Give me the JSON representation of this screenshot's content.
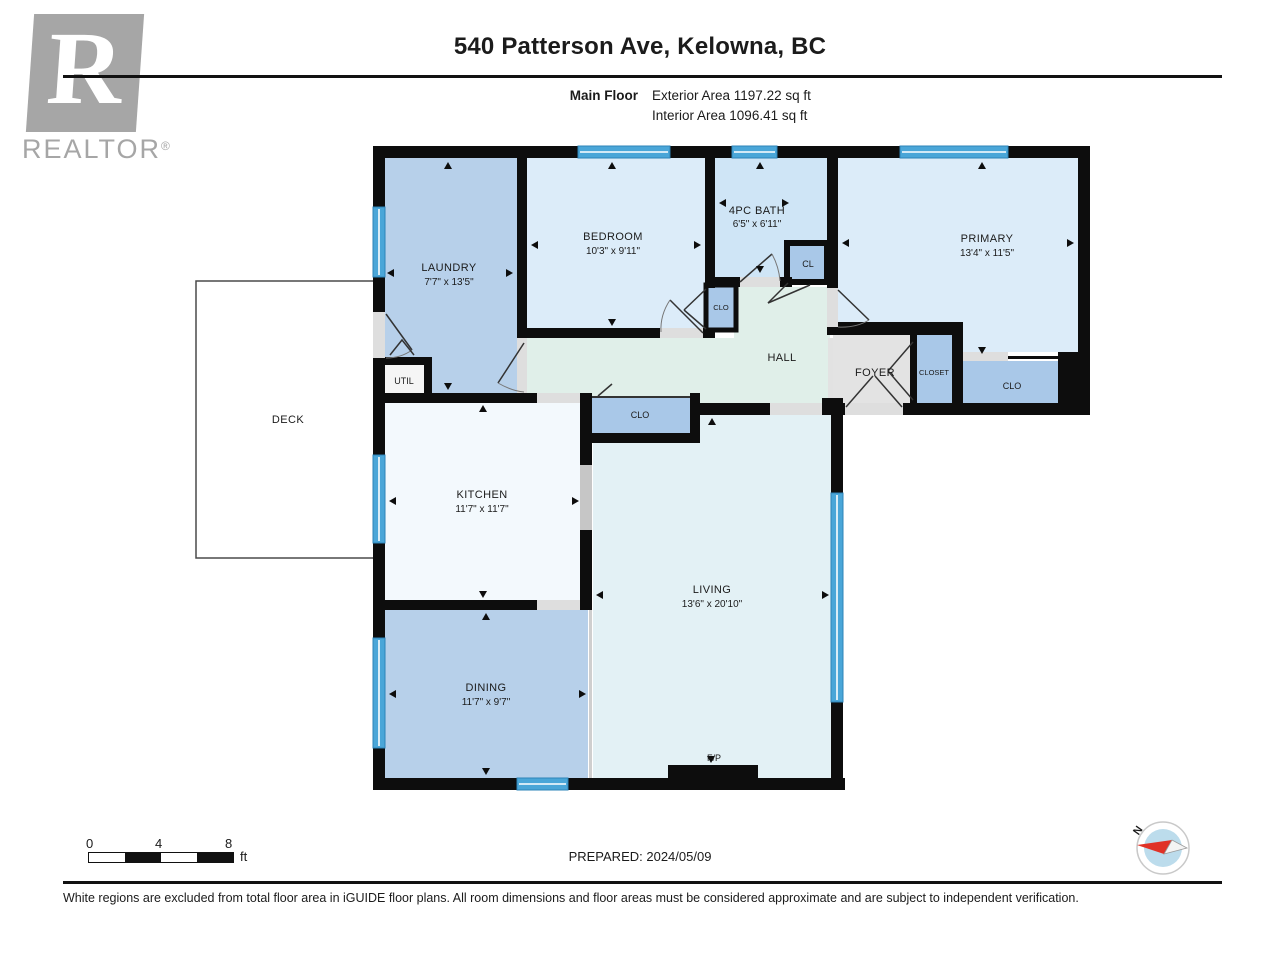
{
  "header": {
    "title": "540 Patterson Ave, Kelowna, BC",
    "floor_label": "Main Floor",
    "exterior_area": "Exterior Area 1197.22 sq ft",
    "interior_area": "Interior Area 1096.41 sq ft",
    "realtor_r": "R",
    "realtor_text": "REALTOR",
    "realtor_reg": "®"
  },
  "rooms": {
    "laundry": {
      "name": "LAUNDRY",
      "dims": "7'7\" x 13'5\""
    },
    "bedroom": {
      "name": "BEDROOM",
      "dims": "10'3\" x 9'11\""
    },
    "bath": {
      "name": "4PC BATH",
      "dims": "6'5\" x 6'11\""
    },
    "cl": {
      "name": "CL"
    },
    "primary": {
      "name": "PRIMARY",
      "dims": "13'4\" x 11'5\""
    },
    "clo_bedroom": {
      "name": "CLO"
    },
    "hall": {
      "name": "HALL"
    },
    "foyer": {
      "name": "FOYER"
    },
    "closet": {
      "name": "CLOSET"
    },
    "clo_right": {
      "name": "CLO"
    },
    "clo_center": {
      "name": "CLO"
    },
    "util": {
      "name": "UTIL"
    },
    "kitchen": {
      "name": "KITCHEN",
      "dims": "11'7\" x 11'7\""
    },
    "living": {
      "name": "LIVING",
      "dims": "13'6\" x 20'10\""
    },
    "dining": {
      "name": "DINING",
      "dims": "11'7\" x 9'7\""
    },
    "deck": {
      "name": "DECK"
    },
    "fireplace": {
      "name": "F/P"
    }
  },
  "footer": {
    "scale_ticks": [
      "0",
      "4",
      "8"
    ],
    "scale_unit": "ft",
    "prepared": "PREPARED: 2024/05/09",
    "north": "N",
    "disclaimer": "White regions are excluded from total floor area in iGUIDE floor plans. All room dimensions and floor areas must be considered approximate and are subject to independent verification."
  },
  "colors": {
    "wall": "#0d0d0d",
    "room_medium_blue": "#b7d0ea",
    "room_light_blue": "#dcecf9",
    "room_bath_blue": "#cfe5f6",
    "room_closet_blue": "#a9c8e8",
    "hall_mint": "#e0efe9",
    "living_cyan": "#e3f1f5",
    "kitchen_white": "#f3f9fd",
    "foyer_gray": "#e3e3e3",
    "window_blue": "#4aa6d8",
    "compass_red": "#e03227",
    "logo_gray": "#a6a6a6"
  }
}
